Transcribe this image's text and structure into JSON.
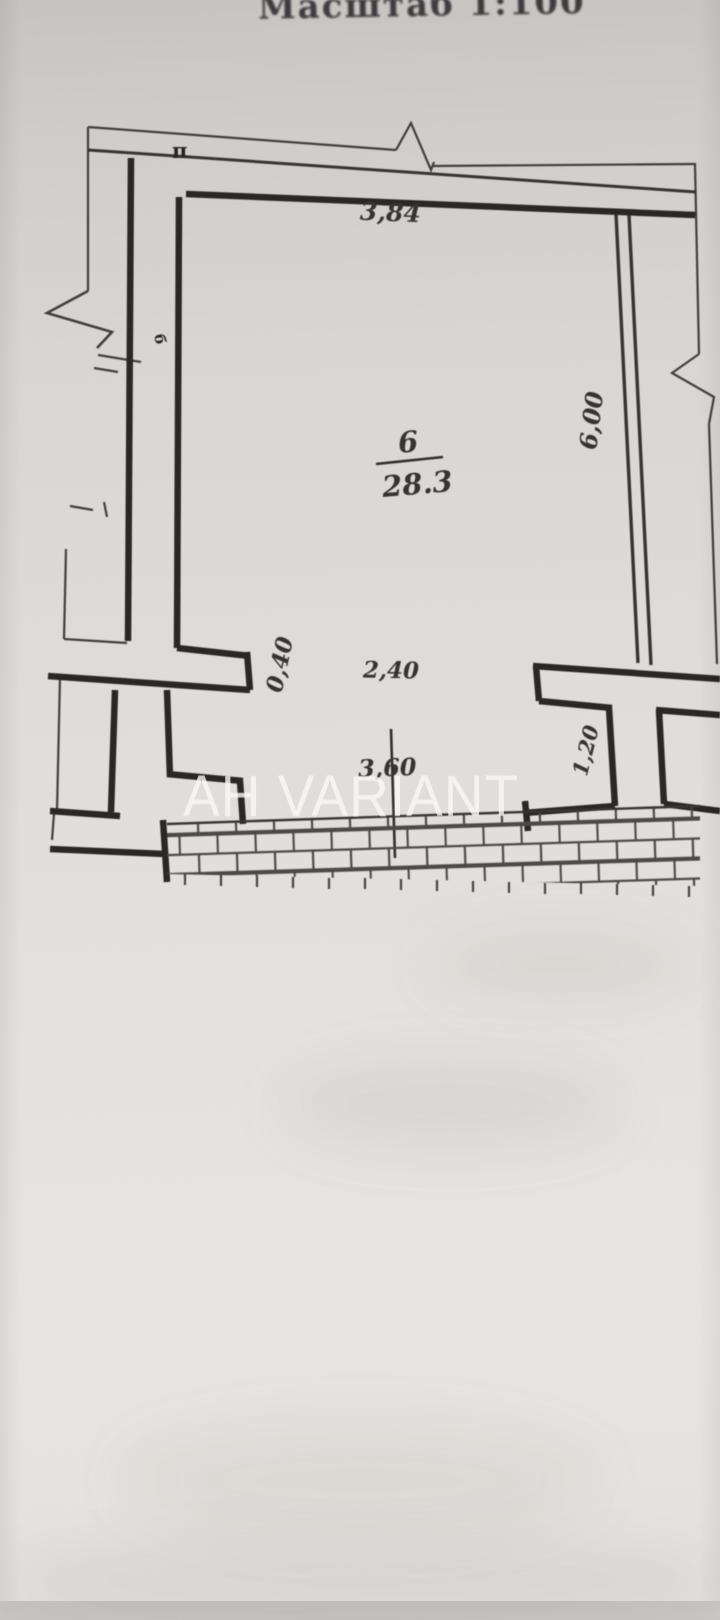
{
  "photo": {
    "title": "Масштаб 1:100"
  },
  "watermark": {
    "text": "АН VARIANT"
  },
  "plan": {
    "room": {
      "number": "6",
      "area": "28.3"
    },
    "dimensions": {
      "top_width": "3,84",
      "right_height": "6,00",
      "left_pier_width": "0,40",
      "opening_width": "2,40",
      "bottom_opening_width": "3,60",
      "right_pier_width": "1,20"
    },
    "markers": {
      "top_wall": "п",
      "left_wall": "б"
    }
  },
  "colors": {
    "ink": "#2b2927",
    "paper": "#dcdad6",
    "watermark": "#faf8f6",
    "mortar": "#4a4744"
  }
}
